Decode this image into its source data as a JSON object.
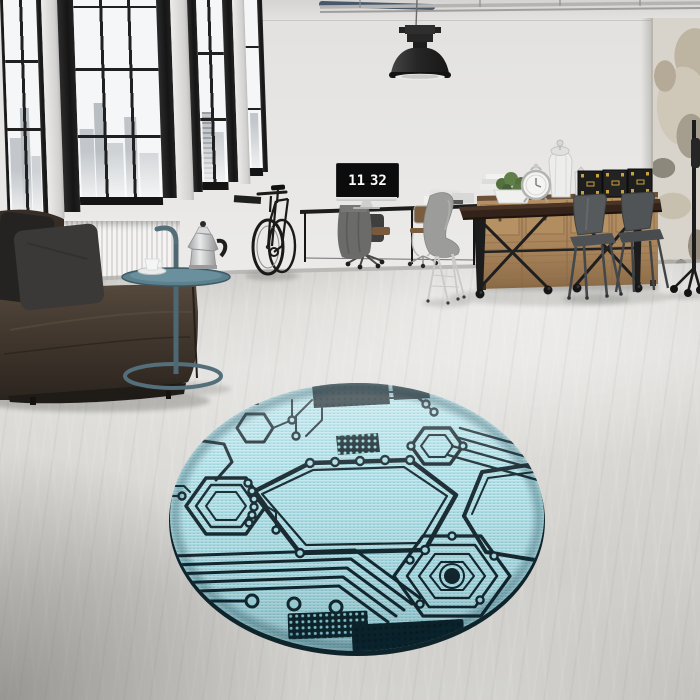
{
  "scene": {
    "type": "interior photograph (3D render)",
    "room": "industrial loft living room with factory windows",
    "focal_item": "round light-blue circuit-board pattern rug on concrete floor"
  },
  "desk_clock": {
    "hours": "11",
    "minutes": "32"
  },
  "palette": {
    "wall": "#ecebe9",
    "window_frame": "#1b1b1b",
    "window_pane": "#f5f6f7",
    "skyline": "#c3c7cb",
    "radiator": "#f0efed",
    "sofa_leather": "#3e352c",
    "cushion_dark": "#262524",
    "cushion_gray": "#3a3938",
    "side_table_teal": "#5d808d",
    "moka_silver": "#c9cacb",
    "floor_concrete": "#d5d4d0",
    "sideboard_wood": "#ac875b",
    "dining_table_wood": "#33231a",
    "shell_chair": "#9c9c9a",
    "tolix_chair": "#53575a",
    "trunk_black": "#1e1e1e",
    "trunk_hardware": "#c8a23f",
    "distressed_wall": "#c4bcab",
    "rug_base": "#a9dde5",
    "rug_trace": "#13242b",
    "rug_chip": "#0d2026"
  },
  "objects": [
    "pendant-lamp",
    "ceiling-pipes",
    "factory-windows",
    "city-skyline",
    "radiator",
    "leather-sofa",
    "throw-pillows",
    "side-table",
    "moka-pot",
    "coffee-cup",
    "bicycle",
    "wall-desk",
    "monitor-clock",
    "office-chairs",
    "draped-jacket",
    "paper-stacks",
    "wooden-sideboard",
    "potted-plant",
    "decorative-lanterns",
    "ornate-table-clock",
    "storage-trunks",
    "dining-table",
    "shell-chair",
    "tolix-chairs",
    "rolling-floor-lamp",
    "distressed-concrete-column",
    "concrete-floor",
    "circuit-board-rug"
  ]
}
